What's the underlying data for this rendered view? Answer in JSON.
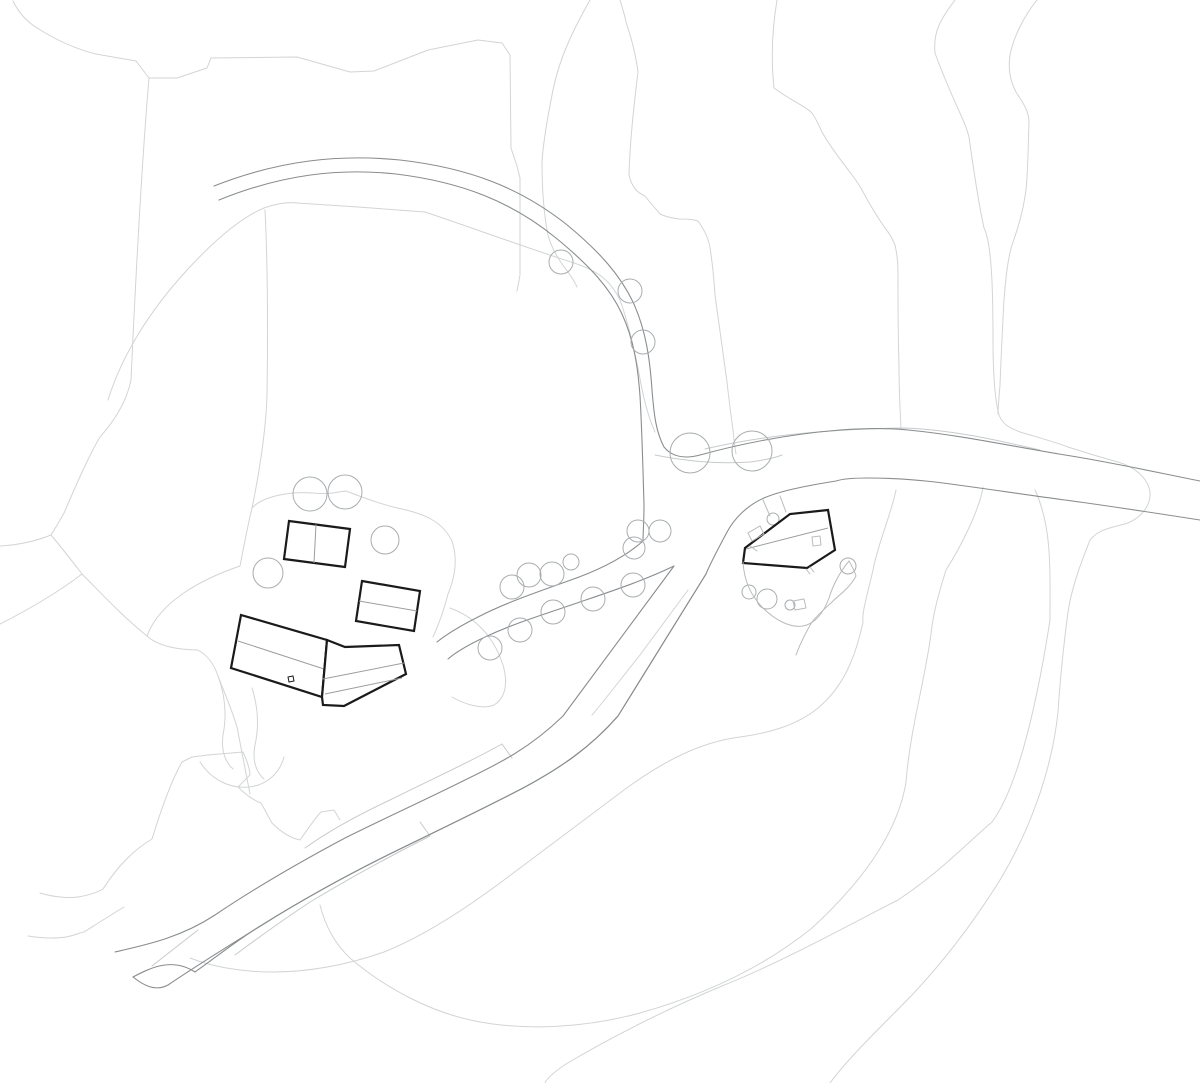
{
  "meta": {
    "title": "architectural-site-plan",
    "canvas": {
      "width": 1200,
      "height": 1083
    }
  },
  "style": {
    "background": "#ffffff",
    "contour_color": "#d2d4d5",
    "bank_color": "#c7cacb",
    "road_color": "#8a8d8f",
    "tree_color": "#a9adaf",
    "detail_color": "#b9bcbe",
    "building_color": "#1a1a1a",
    "building_fill": "#ffffff",
    "building_interior_color": "#9b9ea0"
  },
  "layers": {
    "contours": [
      {
        "d": "M13,1 C20,15 28,23 42,31 C60,42 80,50 96,54 L136,61 L149,78 L177,78 L207,68 L211,58 L297,57 L350,72 L374,71 L428,50 L478,40 L502,43 L510,55 L511,148 L517,166 L520,178 L520,275 L517,291"
      },
      {
        "d": "M149,78 C142,160 136,270 131,380 C127,400 115,420 100,437 C85,462 70,500 64,513 C58,524 54,530 51,535"
      },
      {
        "d": "M0,546 C18,545 36,541 51,535"
      },
      {
        "d": "M51,535 C62,548 72,561 82,574 C60,591 28,610 0,624"
      },
      {
        "d": "M82,574 C100,592 122,616 147,636"
      },
      {
        "d": "M108,400 C122,355 150,310 188,269 C212,243 240,218 264,208 C278,203 288,202 297,203 L358,207 L425,212 C470,227 530,249 574,263 C598,271 610,280 620,300 C628,322 633,345 638,368 C642,390 646,412 655,432"
      },
      {
        "d": "M265,210 C268,270 268,330 267,395 C266,430 259,475 252,508"
      },
      {
        "d": "M590,0 C576,25 560,55 553,90 C547,120 543,145 542,162 C542,185 543,210 548,235 C552,250 560,262 568,272 C572,278 575,282 577,287"
      },
      {
        "d": "M620,0 C623,10 625,16 626,22 C632,40 636,55 638,72 C634,105 630,140 629,175 C632,188 638,193 645,196 C652,205 657,210 660,214 C666,217 672,218 679,219 C686,219 692,219 698,221 C706,232 710,242 711,255 C713,268 714,280 715,295 C719,325 723,355 727,382 C729,400 731,416 733,430 C734,440 735,448 736,454"
      },
      {
        "d": "M777,0 C772,30 771,60 774,88 C790,100 805,106 812,113 C818,122 820,128 822,132 C832,150 845,165 852,175 C858,183 860,186 862,190 C870,205 878,218 885,228 C890,234 893,240 895,245 C898,258 898,268 898,280 C898,310 898,335 899,365 C899,390 900,410 901,428"
      },
      {
        "d": "M955,0 C940,20 933,32 935,53 C950,95 965,120 969,137 C975,180 980,210 984,228 C991,242 993,280 993,340 C993,375 995,400 999,415 C1003,425 1010,428 1020,432 C1040,438 1055,442 1068,447 C1090,454 1103,458 1118,462 C1135,467 1148,478 1150,492 C1151,505 1142,517 1128,523 C1112,528 1100,528 1090,540 C1083,558 1072,585 1068,612 C1063,650 1060,680 1058,712 C1052,770 1030,830 1000,880 C975,920 945,960 912,995 C880,1028 850,1056 830,1083"
      },
      {
        "d": "M1037,0 C1025,15 1014,35 1010,55 C1008,70 1010,80 1016,92 C1024,104 1029,112 1029,122 C1028,150 1028,170 1026,190 C1023,212 1018,228 1012,245 C1008,258 1006,275 1004,300 C1002,335 1001,360 1000,385 C999,398 998,408 998,414"
      },
      {
        "d": "M147,636 C160,600 205,578 240,566 C245,540 249,520 252,508 C262,497 288,491 312,493 C332,495 340,491 346,491 C362,497 382,505 402,509 C424,514 442,521 452,541 C459,562 453,582 448,594 C443,614 438,626 433,637"
      },
      {
        "d": "M147,636 C158,646 178,650 198,650 C210,657 215,667 218,676 C227,699 233,713 237,727 C243,758 247,778 250,794"
      },
      {
        "d": "M218,676 C225,695 227,715 223,735 C221,750 225,762 233,769"
      },
      {
        "d": "M252,688 C258,707 259,727 255,745 C252,760 256,772 264,779"
      },
      {
        "d": "M200,762 C211,779 229,789 249,787 C268,785 280,772 284,757"
      },
      {
        "d": "M103,889 C119,864 135,849 152,839 C164,800 174,776 182,762 L192,757 L208,755 L243,752 C248,763 250,770 250,775 L238,787 C246,795 253,800 261,803 C265,810 268,816 272,823 C281,832 290,838 300,840 C308,829 315,818 321,812 L334,810 L340,820"
      },
      {
        "d": "M40,893 C56,898 72,898 78,897 C90,895 98,892 103,889"
      },
      {
        "d": "M28,936 C46,939 60,938 66,937 C76,935 82,932 84,932 C92,927 101,921 108,917 C114,913 119,910 124,907"
      },
      {
        "d": "M896,490 C891,515 878,543 873,570 C866,600 862,612 863,622 C855,660 842,688 818,708 C796,726 768,733 740,737 C700,742 662,762 624,790 C584,820 544,850 504,880 C464,910 424,936 384,952 C344,966 308,972 272,972 C240,972 210,966 190,958"
      },
      {
        "d": "M983,487 C980,508 962,545 946,570 C938,596 933,614 931,634 C925,680 910,730 906,782 C898,832 862,882 812,928 C760,970 700,996 640,1013 C585,1028 525,1031 475,1021 C430,1012 385,988 350,958 C335,944 325,925 320,905"
      },
      {
        "d": "M1035,490 C1052,527 1050,568 1050,620 C1041,678 1022,782 992,822 C964,846 940,872 898,900 C843,928 782,962 722,986 C662,1011 606,1040 566,1064 C554,1072 547,1078 545,1083"
      },
      {
        "d": "M450,608 C478,618 495,640 503,665 C508,682 506,698 494,705 C482,710 464,704 452,697"
      },
      {
        "d": "M688,590 L640,655 C620,680 605,700 592,715"
      }
    ],
    "banks": [
      {
        "d": "M705,449 C760,436 830,429 905,428 C955,430 1000,441 1040,450"
      },
      {
        "d": "M655,455 C690,462 720,464 750,462 C765,460 775,458 782,455"
      },
      {
        "d": "M502,744 C470,762 430,780 390,800 C360,814 330,830 305,848"
      },
      {
        "d": "M502,744 L512,758"
      },
      {
        "d": "M430,836 C390,856 350,878 310,902 C280,922 255,940 235,955"
      },
      {
        "d": "M430,836 L420,822"
      },
      {
        "d": "M198,930 C180,944 165,956 152,966"
      }
    ],
    "roads": [
      {
        "d": "M214,186 C280,160 340,154 400,160 C470,168 520,188 566,224 C600,252 620,275 633,302 C646,330 650,360 652,390 C654,415 656,432 664,447 C672,457 685,459 700,455 C740,444 790,434 840,430 C870,428 890,428 908,430 C960,435 1010,446 1065,455 C1110,462 1155,472 1200,481"
      },
      {
        "d": "M219,200 C283,174 340,168 396,174 C462,182 512,202 556,238 C590,266 610,288 622,314 C634,340 638,368 640,396 C642,430 643,470 644,505 C644,522 643,533 643,541 C625,557 600,570 568,581 C535,593 505,603 478,617 C460,626 447,634 437,642"
      },
      {
        "d": "M1200,520 C1155,513 1110,506 1065,500 C1020,494 975,487 935,482 C910,479 888,478 868,478 C850,478 842,479 836,481 C805,486 780,491 764,498 C748,505 734,518 726,534 C717,551 710,564 706,574"
      },
      {
        "d": "M706,574 L618,716 C590,748 560,768 525,787 C485,808 445,827 400,849 C355,871 305,898 262,925 C240,938 215,958 195,972 C172,957 150,968 133,977 M706,574 L618,716"
      },
      {
        "d": "M674,566 L563,716 C530,748 500,763 465,780 C425,800 385,818 345,838 C300,862 255,888 215,915 C180,938 145,945 115,952"
      },
      {
        "d": "M706,574 L618,716 C590,748 560,768 525,787 C485,808 445,827 400,849 C355,871 305,898 262,925 C225,948 193,968 168,985 C155,992 143,985 133,977"
      },
      {
        "d": "M674,566 C645,580 615,590 580,602 C545,614 515,623 485,637 C468,645 456,652 448,659"
      }
    ],
    "trees": [
      {
        "cx": 561,
        "cy": 262,
        "r": 12
      },
      {
        "cx": 630,
        "cy": 291,
        "r": 12
      },
      {
        "cx": 643,
        "cy": 342,
        "r": 12
      },
      {
        "cx": 690,
        "cy": 453,
        "r": 20
      },
      {
        "cx": 752,
        "cy": 451,
        "r": 20
      },
      {
        "cx": 310,
        "cy": 494,
        "r": 17
      },
      {
        "cx": 345,
        "cy": 492,
        "r": 17
      },
      {
        "cx": 268,
        "cy": 573,
        "r": 15
      },
      {
        "cx": 385,
        "cy": 540,
        "r": 14
      },
      {
        "cx": 512,
        "cy": 587,
        "r": 12
      },
      {
        "cx": 529,
        "cy": 575,
        "r": 12
      },
      {
        "cx": 552,
        "cy": 574,
        "r": 12
      },
      {
        "cx": 571,
        "cy": 562,
        "r": 8
      },
      {
        "cx": 593,
        "cy": 599,
        "r": 12
      },
      {
        "cx": 633,
        "cy": 585,
        "r": 12
      },
      {
        "cx": 553,
        "cy": 612,
        "r": 12
      },
      {
        "cx": 520,
        "cy": 630,
        "r": 12
      },
      {
        "cx": 490,
        "cy": 648,
        "r": 12
      },
      {
        "cx": 638,
        "cy": 531,
        "r": 11
      },
      {
        "cx": 660,
        "cy": 531,
        "r": 11
      },
      {
        "cx": 634,
        "cy": 548,
        "r": 11
      },
      {
        "cx": 773,
        "cy": 519,
        "r": 6
      },
      {
        "cx": 848,
        "cy": 566,
        "r": 8
      },
      {
        "cx": 749,
        "cy": 592,
        "r": 7
      },
      {
        "cx": 767,
        "cy": 599,
        "r": 10
      },
      {
        "cx": 790,
        "cy": 605,
        "r": 5
      }
    ],
    "buildings": [
      {
        "id": "building-a",
        "outline": "289,521 350,529 345,567 284,559",
        "interior": [
          "M316,524.5 L314,563"
        ],
        "details": []
      },
      {
        "id": "building-b",
        "outline": "362,581 420,591 414,631 356,621",
        "interior": [
          "M359,601 L417,611"
        ],
        "details": []
      },
      {
        "id": "building-c-bar",
        "outline": "241,615 327,640 322,697 231,668",
        "interior": [
          "M238,641 L324,669"
        ],
        "details": [
          "288,677 293,676 294,681 289,682"
        ]
      },
      {
        "id": "building-c-wing",
        "outline": "327,640 345,647 399,645 406,674 344,706 323,705 322,697",
        "interior": [
          "M323,679 L404,663",
          "M325,694 L402,678"
        ],
        "details": []
      },
      {
        "id": "building-d",
        "outline": "828,510 790,514 745,548 743,563 807,568 835,550",
        "interior": [
          "M746,549 L828,528"
        ],
        "details": []
      }
    ],
    "site_details": [
      {
        "type": "path",
        "d": "M743,562 C744,580 751,596 763,608 C775,620 790,628 803,626 C815,624 824,612 829,598 C833,585 840,572 849,561"
      },
      {
        "type": "path",
        "d": "M849,561 C853,568 855,572 856,576 C850,587 842,593 834,600 C826,608 818,614 812,622 C806,632 800,644 796,655"
      },
      {
        "type": "polygon",
        "points": "793,601 804,599 806,608 795,610"
      },
      {
        "type": "polygon",
        "points": "752,541 748,533 760,526 764,534"
      },
      {
        "type": "polygon",
        "points": "812,537 820,536 821,545 813,546"
      },
      {
        "type": "path",
        "d": "M750,546 L757,551"
      },
      {
        "type": "path",
        "d": "M806,569 L810,574"
      },
      {
        "type": "path",
        "d": "M810,567 L814,572"
      },
      {
        "type": "path",
        "d": "M770,516 L763,500"
      },
      {
        "type": "path",
        "d": "M786,512 L780,496"
      }
    ]
  }
}
